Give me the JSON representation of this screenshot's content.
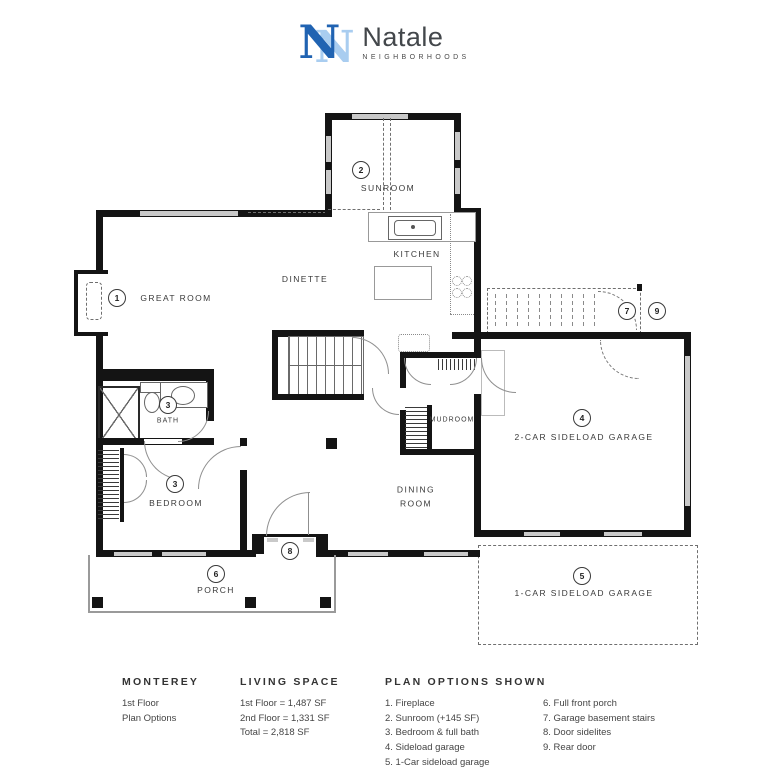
{
  "brand": {
    "monogram": "N",
    "name": "Natale",
    "tagline": "NEIGHBORHOODS"
  },
  "colors": {
    "logo_dark": "#2063b2",
    "logo_light": "#a9cdf0",
    "wall": "#141414",
    "window": "#c9c9c9"
  },
  "plan": {
    "labels": {
      "sunroom": "SUNROOM",
      "kitchen": "KITCHEN",
      "dinette": "DINETTE",
      "great_room": "GREAT ROOM",
      "bath": "BATH",
      "bedroom": "BEDROOM",
      "mudroom": "MUDROOM",
      "dining_room": "DINING ROOM",
      "garage2": "2-CAR SIDELOAD GARAGE",
      "garage1": "1-CAR SIDELOAD GARAGE",
      "porch": "PORCH"
    },
    "markers": {
      "m1": "1",
      "m2": "2",
      "m3a": "3",
      "m3b": "3",
      "m4": "4",
      "m5": "5",
      "m6": "6",
      "m7": "7",
      "m8": "8",
      "m9": "9"
    }
  },
  "footer": {
    "plan_name": {
      "title": "MONTEREY",
      "line1": "1st Floor",
      "line2": "Plan Options"
    },
    "living_space": {
      "title": "LIVING SPACE",
      "line1": "1st Floor = 1,487 SF",
      "line2": "2nd Floor = 1,331 SF",
      "line3": "Total = 2,818 SF"
    },
    "options": {
      "title": "PLAN OPTIONS SHOWN",
      "col1": [
        "1. Fireplace",
        "2. Sunroom (+145 SF)",
        "3. Bedroom & full bath",
        "4. Sideload garage",
        "5. 1-Car sideload garage"
      ],
      "col2": [
        "6. Full front porch",
        "7. Garage basement stairs",
        "8. Door sidelites",
        "9. Rear door"
      ]
    }
  }
}
